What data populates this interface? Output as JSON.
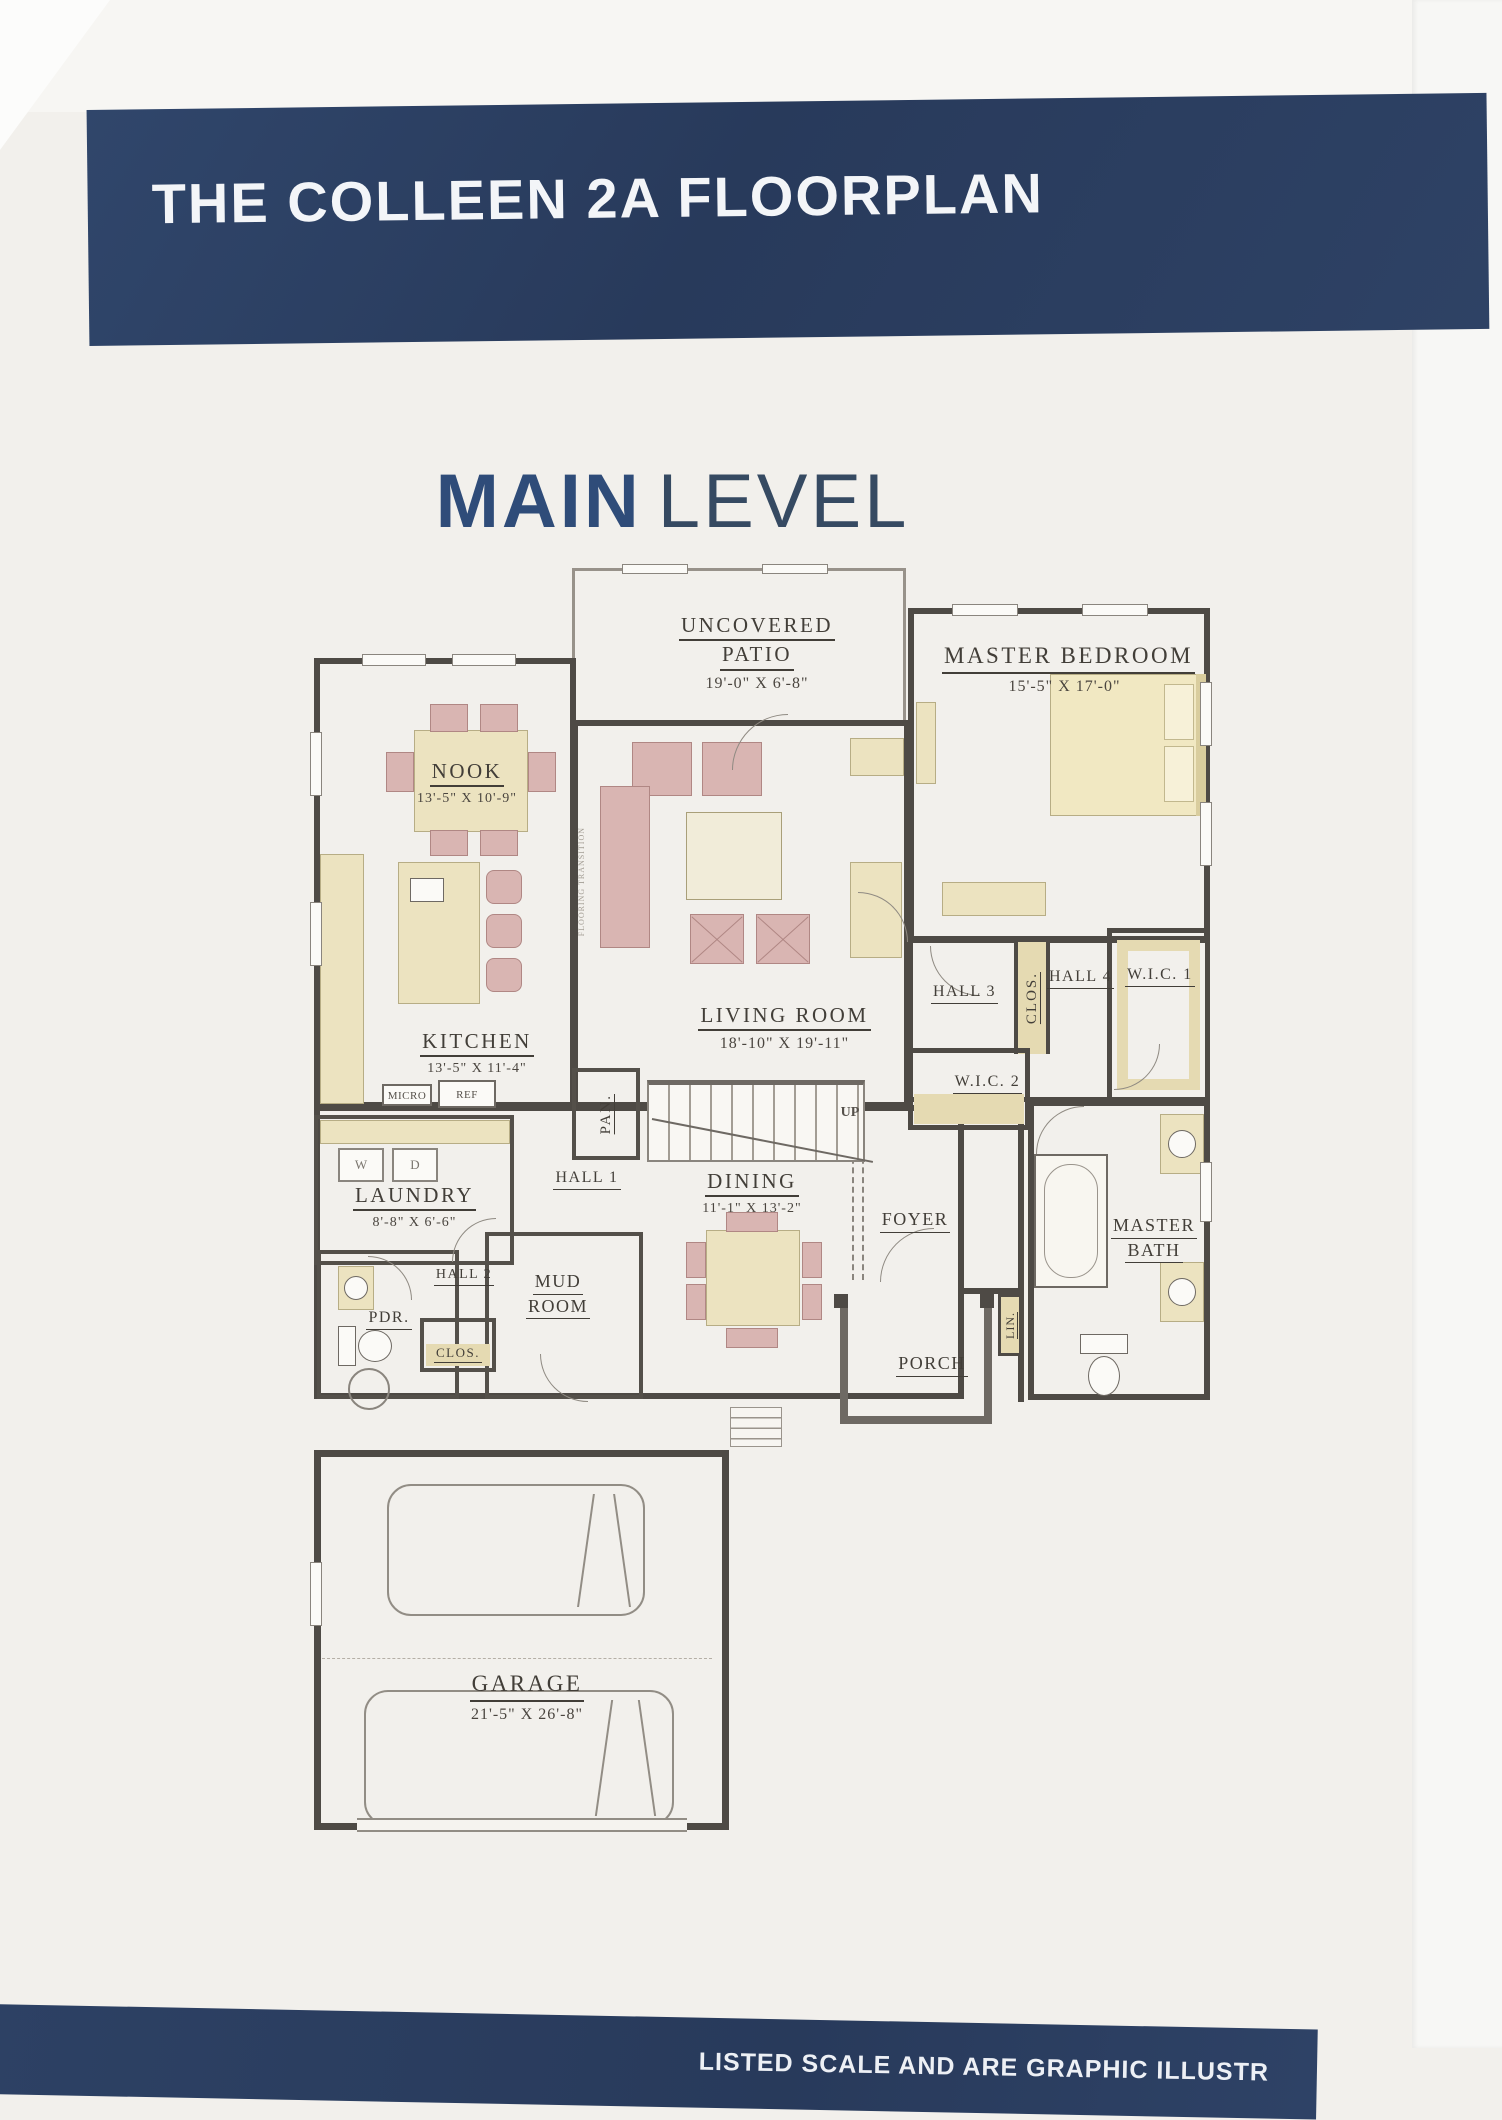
{
  "banner": {
    "title": "THE COLLEEN 2A FLOORPLAN"
  },
  "level_heading": {
    "word_bold": "MAIN",
    "word_light": "LEVEL"
  },
  "rooms": {
    "uncovered_patio": {
      "line1": "UNCOVERED",
      "line2": "PATIO",
      "dims": "19'-0\" X 6'-8\""
    },
    "master_bedroom": {
      "name": "MASTER BEDROOM",
      "dims": "15'-5\" X 17'-0\""
    },
    "nook": {
      "name": "NOOK",
      "dims": "13'-5\" X 10'-9\""
    },
    "kitchen": {
      "name": "KITCHEN",
      "dims": "13'-5\" X 11'-4\"",
      "micro": "MICRO",
      "ref": "REF"
    },
    "living_room": {
      "name": "LIVING ROOM",
      "dims": "18'-10\" X 19'-11\""
    },
    "hall_3": {
      "name": "HALL 3"
    },
    "closet_hall": {
      "name": "CLOS."
    },
    "hall_4": {
      "name": "HALL 4"
    },
    "wic_1": {
      "name": "W.I.C. 1"
    },
    "wic_2": {
      "name": "W.I.C. 2"
    },
    "pantry": {
      "name": "PAN."
    },
    "stairs": {
      "label": "UP"
    },
    "laundry": {
      "name": "LAUNDRY",
      "dims": "8'-8\" X 6'-6\"",
      "washer": "W",
      "dryer": "D"
    },
    "hall_1": {
      "name": "HALL 1"
    },
    "dining": {
      "name": "DINING",
      "dims": "11'-1\" X 13'-2\""
    },
    "foyer": {
      "name": "FOYER"
    },
    "master_bath": {
      "line1": "MASTER",
      "line2": "BATH"
    },
    "mud_room": {
      "line1": "MUD",
      "line2": "ROOM"
    },
    "powder": {
      "name": "PDR."
    },
    "hall_2": {
      "name": "HALL 2"
    },
    "closet_2": {
      "name": "CLOS."
    },
    "linen": {
      "name": "LIN."
    },
    "porch": {
      "name": "PORCH"
    },
    "garage": {
      "name": "GARAGE",
      "dims": "21'-5\" X 26'-8\""
    }
  },
  "annotations": {
    "flooring_note": "FLOORING TRANSITION"
  },
  "footer": {
    "disclaimer_fragment": "LISTED SCALE AND ARE GRAPHIC ILLUSTR"
  }
}
